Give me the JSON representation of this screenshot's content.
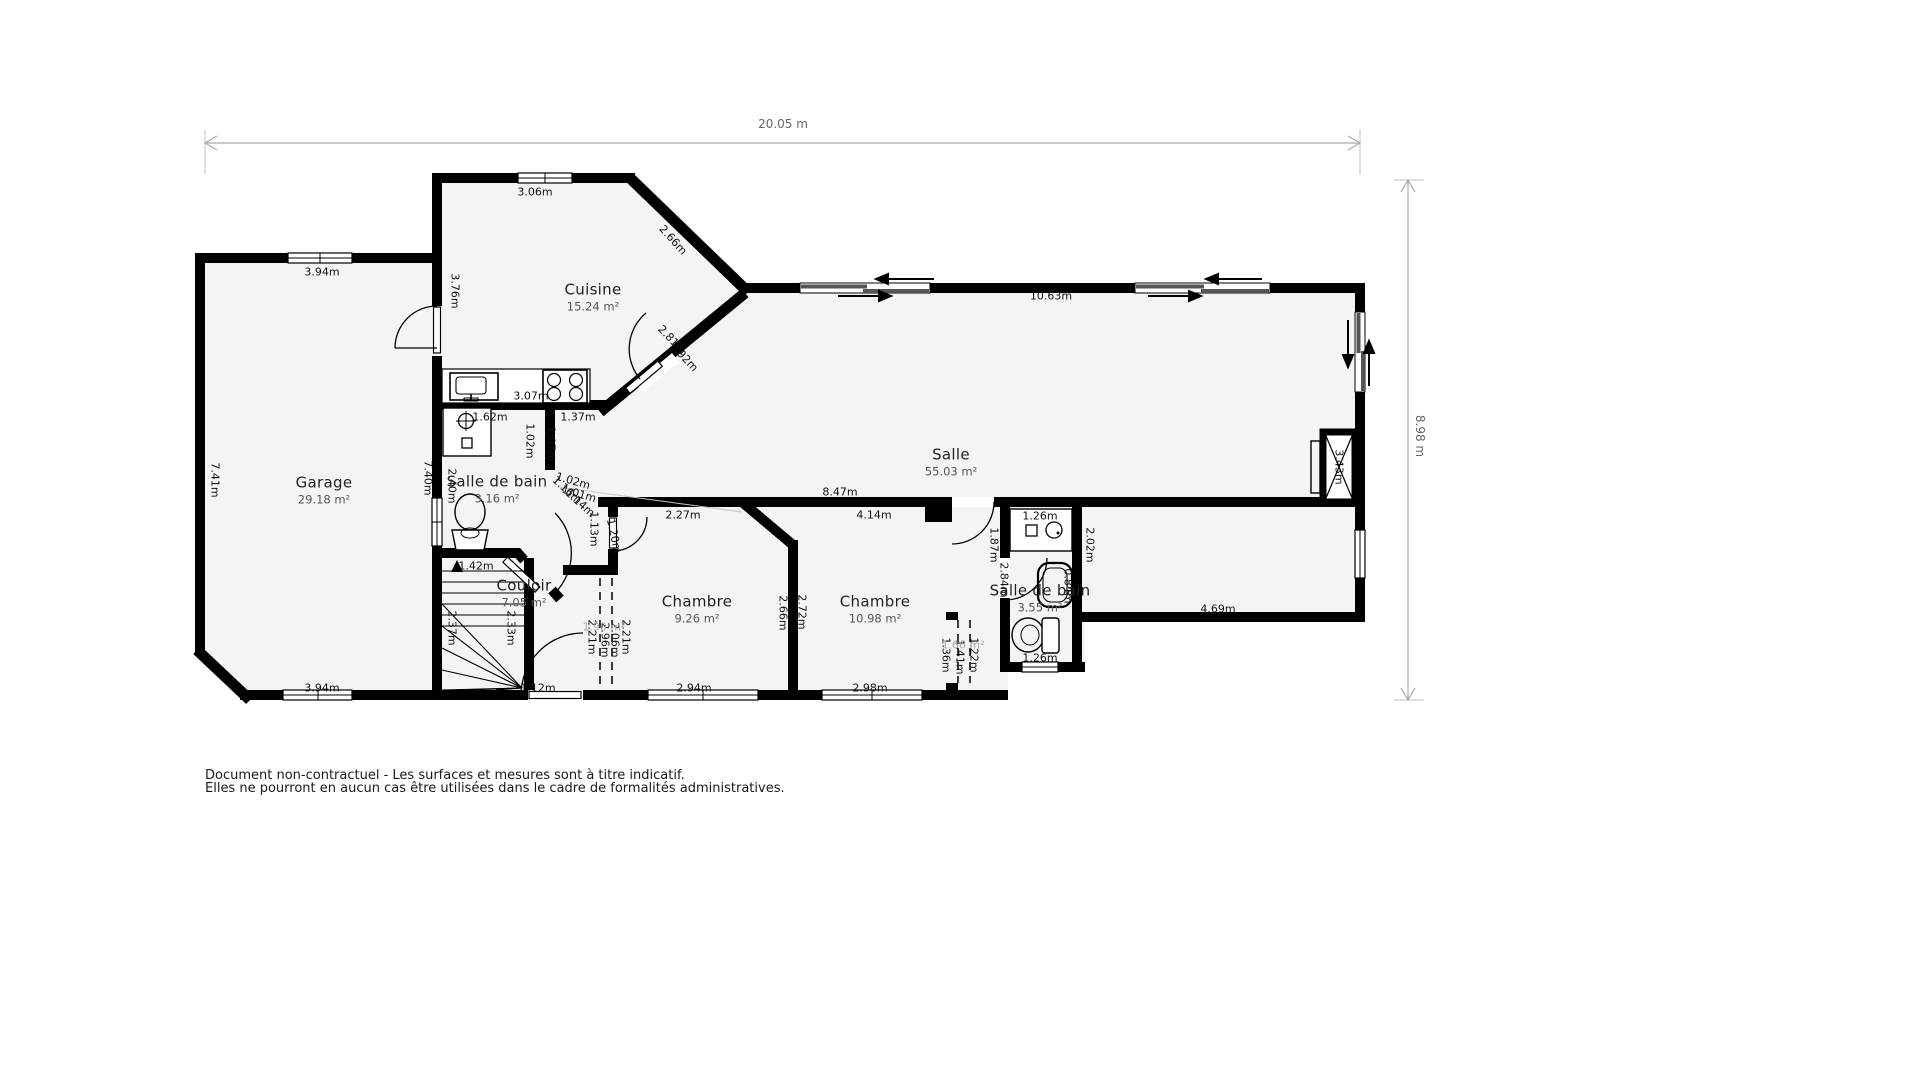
{
  "dimensions": {
    "overall_width_label": "20.05 m",
    "overall_height_label": "8.98 m"
  },
  "colors": {
    "wall": "#000000",
    "floor": "#f4f4f4",
    "label": "#111111",
    "area_label": "#555555",
    "dim_label": "#666666"
  },
  "rooms": [
    {
      "name": "Garage",
      "area": "29.18 m²",
      "x": 324,
      "y": 490
    },
    {
      "name": "Cuisine",
      "area": "15.24 m²",
      "x": 593,
      "y": 297
    },
    {
      "name": "Salle",
      "area": "55.03 m²",
      "x": 951,
      "y": 462
    },
    {
      "name": "Salle de bain",
      "area": "3.16 m²",
      "x": 497,
      "y": 489
    },
    {
      "name": "Couloir",
      "area": "7.05 m²",
      "x": 524,
      "y": 593
    },
    {
      "name": "Chambre",
      "area": "9.26 m²",
      "x": 697,
      "y": 609
    },
    {
      "name": "Chambre",
      "area": "10.98 m²",
      "x": 875,
      "y": 609
    },
    {
      "name": "Salle de bain",
      "area": "3.55 m²",
      "x": 1040,
      "y": 598
    }
  ],
  "wall_labels": [
    {
      "t": "3.06m",
      "x": 535,
      "y": 192,
      "r": 0
    },
    {
      "t": "3.94m",
      "x": 322,
      "y": 272,
      "r": 0
    },
    {
      "t": "2.66m",
      "x": 673,
      "y": 240,
      "r": 48
    },
    {
      "t": "3.76m",
      "x": 455,
      "y": 291,
      "r": 90
    },
    {
      "t": "10.63m",
      "x": 1051,
      "y": 296,
      "r": 0
    },
    {
      "t": "2.81m",
      "x": 672,
      "y": 340,
      "r": 47
    },
    {
      "t": "2.92m",
      "x": 684,
      "y": 357,
      "r": 47
    },
    {
      "t": "3.07m",
      "x": 531,
      "y": 396,
      "r": 0
    },
    {
      "t": "1.37m",
      "x": 578,
      "y": 417,
      "r": 0
    },
    {
      "t": "1.62m",
      "x": 490,
      "y": 417,
      "r": 0
    },
    {
      "t": "1.02m",
      "x": 530,
      "y": 441,
      "r": 90
    },
    {
      "t": "1.07m",
      "x": 551,
      "y": 444,
      "r": 90
    },
    {
      "t": "7.41m",
      "x": 215,
      "y": 480,
      "r": 90
    },
    {
      "t": "7.40m",
      "x": 428,
      "y": 478,
      "r": 90
    },
    {
      "t": "2.40m",
      "x": 452,
      "y": 486,
      "r": 90
    },
    {
      "t": "1.16m",
      "x": 567,
      "y": 490,
      "r": 42
    },
    {
      "t": "1.14m",
      "x": 580,
      "y": 503,
      "r": 42
    },
    {
      "t": "1.02m",
      "x": 573,
      "y": 481,
      "r": 16
    },
    {
      "t": "1.01m",
      "x": 579,
      "y": 494,
      "r": 16
    },
    {
      "t": "1.13m",
      "x": 594,
      "y": 529,
      "r": 90
    },
    {
      "t": "1.20m",
      "x": 614,
      "y": 536,
      "r": 78
    },
    {
      "t": "2.27m",
      "x": 683,
      "y": 515,
      "r": 0
    },
    {
      "t": "8.47m",
      "x": 840,
      "y": 492,
      "r": 0
    },
    {
      "t": "4.14m",
      "x": 874,
      "y": 515,
      "r": 0
    },
    {
      "t": "1.26m",
      "x": 1040,
      "y": 516,
      "r": 0
    },
    {
      "t": "1.87m",
      "x": 994,
      "y": 545,
      "r": 90
    },
    {
      "t": "2.02m",
      "x": 1090,
      "y": 545,
      "r": 90
    },
    {
      "t": "2.84m",
      "x": 1004,
      "y": 580,
      "r": 90
    },
    {
      "t": "0.84m",
      "x": 1068,
      "y": 586,
      "r": 90
    },
    {
      "t": "2.66m",
      "x": 783,
      "y": 613,
      "r": 90
    },
    {
      "t": "2.72m",
      "x": 802,
      "y": 612,
      "r": 90
    },
    {
      "t": "2.21m",
      "x": 592,
      "y": 637,
      "r": 90
    },
    {
      "t": "2.96m",
      "x": 605,
      "y": 640,
      "r": 90
    },
    {
      "t": "2.06m",
      "x": 615,
      "y": 640,
      "r": 90
    },
    {
      "t": "2.21m",
      "x": 626,
      "y": 637,
      "r": 90
    },
    {
      "t": "2.37m",
      "x": 452,
      "y": 628,
      "r": 90
    },
    {
      "t": "2.33m",
      "x": 511,
      "y": 628,
      "r": 90
    },
    {
      "t": "1.42m",
      "x": 476,
      "y": 566,
      "r": 0
    },
    {
      "t": "1.36m",
      "x": 946,
      "y": 655,
      "r": 90
    },
    {
      "t": "1.41m",
      "x": 960,
      "y": 657,
      "r": 90
    },
    {
      "t": "1.22m",
      "x": 974,
      "y": 655,
      "r": 90
    },
    {
      "t": "1.26m",
      "x": 1040,
      "y": 658,
      "r": 0
    },
    {
      "t": "2.94m",
      "x": 694,
      "y": 688,
      "r": 0
    },
    {
      "t": "2.98m",
      "x": 870,
      "y": 688,
      "r": 0
    },
    {
      "t": "1.12m",
      "x": 538,
      "y": 688,
      "r": 0
    },
    {
      "t": "3.94m",
      "x": 322,
      "y": 688,
      "r": 0
    },
    {
      "t": "4.69m",
      "x": 1218,
      "y": 609,
      "r": 0
    },
    {
      "t": "3.43m",
      "x": 1339,
      "y": 467,
      "r": 90
    }
  ],
  "closet_area_labels": [
    {
      "t": "1.90 m²",
      "x": 604,
      "y": 627,
      "r": 0
    },
    {
      "t": "1.66 m²",
      "x": 963,
      "y": 645,
      "r": 0
    }
  ],
  "footer": {
    "disclaimer_line1": "Document non-contractuel - Les surfaces et mesures sont à titre indicatif.",
    "disclaimer_line2": "Elles ne pourront en aucun cas être utilisées dans le cadre de formalités administratives."
  }
}
